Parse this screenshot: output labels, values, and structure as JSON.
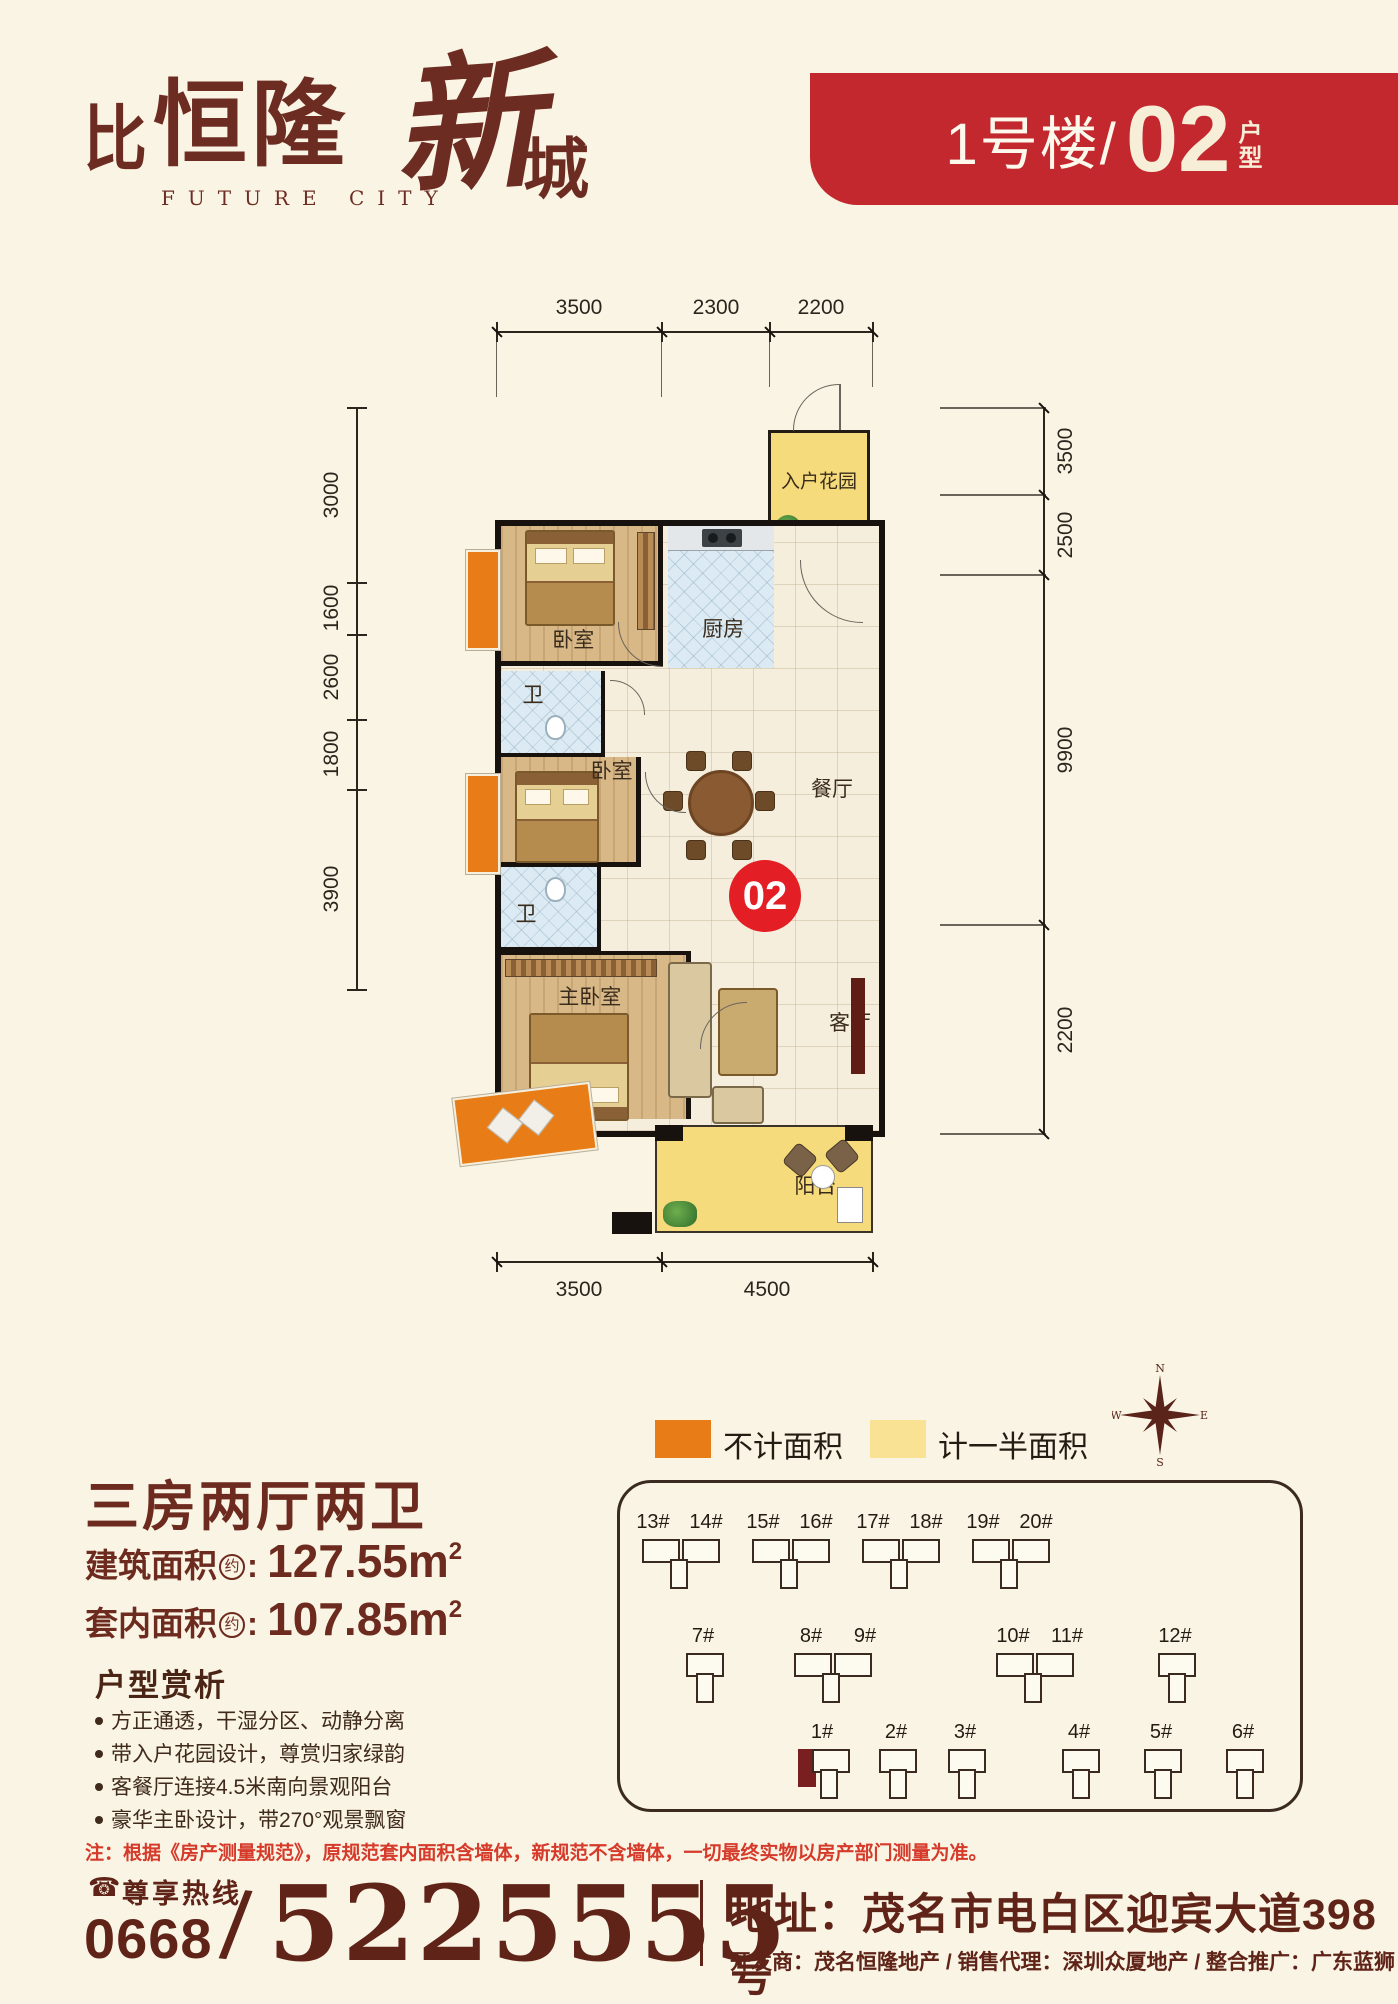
{
  "brand": {
    "mark": "比",
    "name": "恒隆",
    "script1": "新",
    "script2": "城",
    "subtitle": "FUTURE CITY"
  },
  "banner": {
    "building": "1号楼/",
    "unit": "02",
    "suffix_top": "户",
    "suffix_bottom": "型",
    "bg_color": "#c2282e"
  },
  "plan": {
    "unit_badge": "02",
    "badge_color": "#e31e24",
    "rooms": {
      "entry_garden": "入户花园",
      "kitchen": "厨房",
      "bedroom1": "卧室",
      "bath1": "卫",
      "bedroom2": "卧室",
      "bath2": "卫",
      "master": "主卧室",
      "dining": "餐厅",
      "living": "客厅",
      "balcony": "阳台"
    },
    "dims": {
      "top": [
        "3500",
        "2300",
        "2200"
      ],
      "bottom": [
        "3500",
        "4500"
      ],
      "left": [
        "3000",
        "1600",
        "2600",
        "1800",
        "3900"
      ],
      "right": [
        "3500",
        "2500",
        "9900",
        "2200"
      ]
    }
  },
  "legend": {
    "orange_label": "不计面积",
    "orange_color": "#e87d17",
    "yellow_label": "计一半面积",
    "yellow_color": "#f9e293"
  },
  "compass": {
    "n": "N",
    "e": "E",
    "s": "S",
    "w": "W"
  },
  "summary": {
    "title": "三房两厅两卫",
    "rows": [
      {
        "label": "建筑面积",
        "approx": "约",
        "colon": ": ",
        "value": "127.55m",
        "sup": "2"
      },
      {
        "label": "套内面积",
        "approx": "约",
        "colon": ": ",
        "value": "107.85m",
        "sup": "2"
      }
    ]
  },
  "analysis": {
    "heading": "户型赏析",
    "bullets": [
      "方正通透，干湿分区、动静分离",
      "带入户花园设计，尊赏归家绿韵",
      "客餐厅连接4.5米南向景观阳台",
      "豪华主卧设计，带270°观景飘窗"
    ]
  },
  "sitemap": {
    "row1": [
      "13#",
      "14#",
      "15#",
      "16#",
      "17#",
      "18#",
      "19#",
      "20#"
    ],
    "row2": [
      "7#",
      "8#",
      "9#",
      "10#",
      "11#",
      "12#"
    ],
    "row3": [
      "1#",
      "2#",
      "3#",
      "4#",
      "5#",
      "6#"
    ]
  },
  "note": "注：根据《房产测量规范》，原规范套内面积含墙体，新规范不含墙体，一切最终实物以房产部门测量为准。",
  "footer": {
    "hotline_label": "尊享热线",
    "area_code": "0668",
    "slash": "/",
    "phone": "5225555",
    "address": "地址：茂名市电白区迎宾大道398号",
    "credits": "开发商：茂名恒隆地产 / 销售代理：深圳众厦地产 / 整合推广：广东蓝狮"
  }
}
